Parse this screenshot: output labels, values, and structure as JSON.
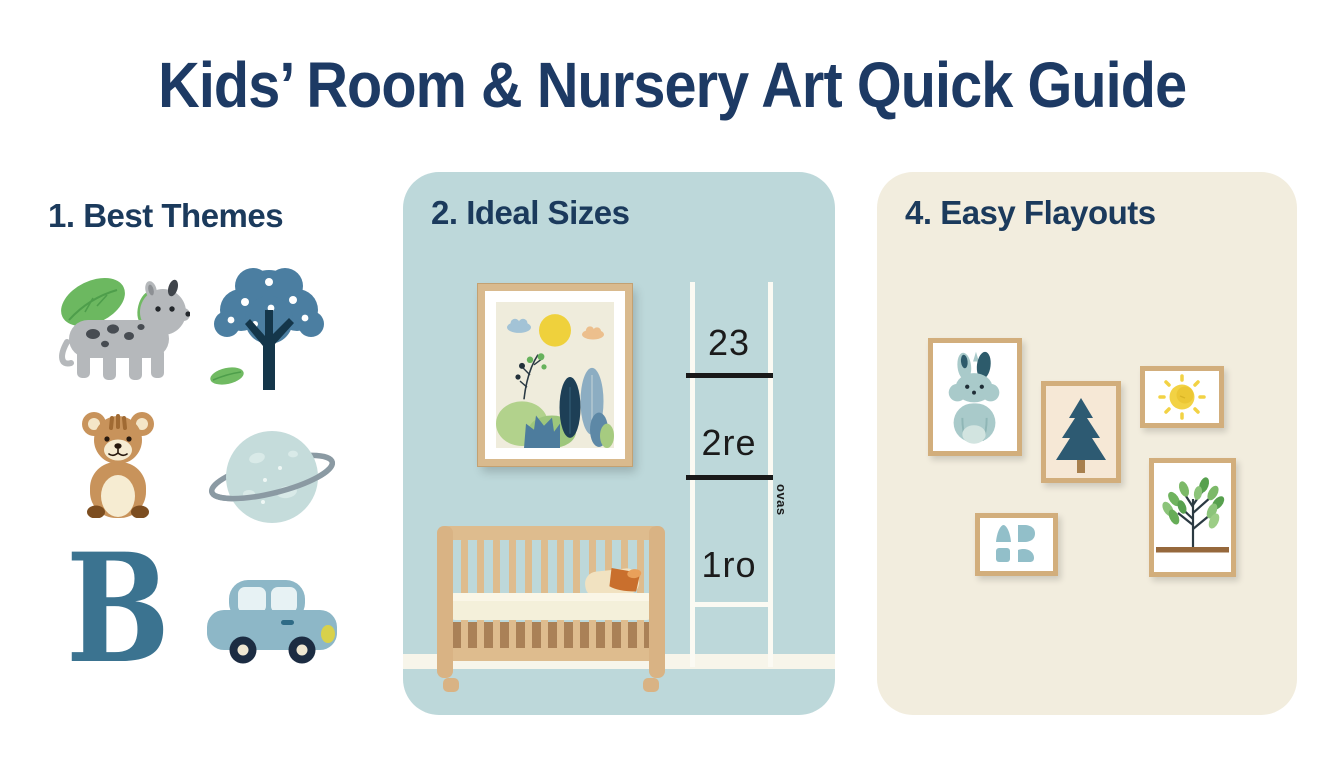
{
  "title": "Kids’ Room & Nursery Art Quick Guide",
  "sections": {
    "themes": {
      "heading": "1. Best Themes",
      "icons": [
        {
          "name": "spotted-animal-icon"
        },
        {
          "name": "dotted-tree-icon"
        },
        {
          "name": "teddy-bear-icon"
        },
        {
          "name": "ringed-planet-icon"
        },
        {
          "name": "letter-b-icon",
          "glyph": "B"
        },
        {
          "name": "car-icon"
        }
      ]
    },
    "sizes": {
      "heading": "2. Ideal Sizes",
      "ruler_labels": [
        "23",
        "2re",
        "1ro"
      ],
      "ruler_side_label": "ovas"
    },
    "layouts": {
      "heading": "4. Easy Flayouts",
      "frames": [
        {
          "name": "bunny-frame"
        },
        {
          "name": "pine-tree-frame"
        },
        {
          "name": "sun-frame"
        },
        {
          "name": "abstract-shapes-frame"
        },
        {
          "name": "leaf-branch-frame"
        }
      ]
    }
  },
  "colors": {
    "title_navy": "#1d3a64",
    "panel_blue": "#bdd8da",
    "panel_cream": "#f2edde",
    "frame_wood": "#d2ae7c",
    "accent_green": "#6cb860",
    "accent_teal": "#3b7390"
  }
}
